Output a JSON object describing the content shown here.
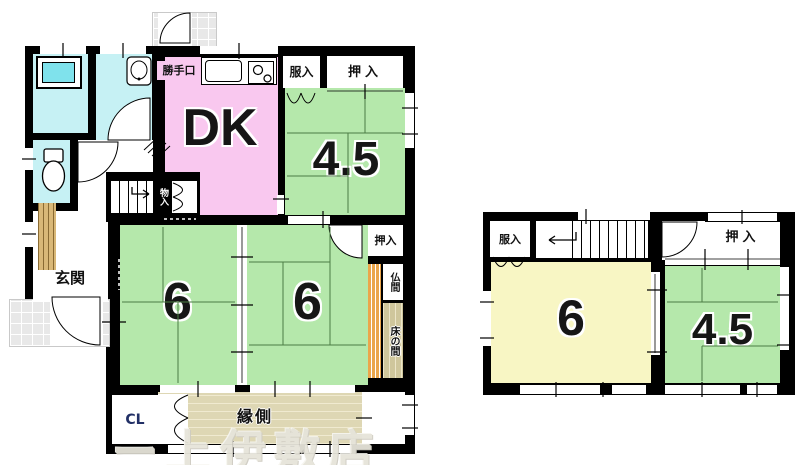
{
  "floor1": {
    "labels": {
      "katteguchi": "勝手口",
      "dk": "DK",
      "fukuire": "服入",
      "oshiire_top": "押入",
      "tatami45": "4.5",
      "monoire": "物入",
      "genkan": "玄関",
      "tatami6_left": "6",
      "tatami6_right": "6",
      "oshiire_mid": "押入",
      "butsuma": "仏間",
      "tokonoma": "床の間",
      "closet": "CL",
      "engawa": "縁側"
    }
  },
  "floor2": {
    "labels": {
      "fukuire": "服入",
      "oshiire": "押入",
      "tatami6": "6",
      "tatami45": "4.5"
    }
  },
  "watermark": "ー上伊敷店",
  "colors": {
    "wall": "#000000",
    "dk_pink": "#f9c8ef",
    "tatami_green": "#b5e8ab",
    "wet_area_cyan": "#c6f1f4",
    "bathtub": "#7fe2ec",
    "room_yellow": "#f8f6c4",
    "engawa_tan": "#ded7b4",
    "tokonoma_wood": "#eba64b",
    "tokonoma_floor": "#cfc69c",
    "entry_wood": "#d9b878",
    "tile_gray": "#e8e8e8",
    "tatami_line": "#4c7d44"
  }
}
